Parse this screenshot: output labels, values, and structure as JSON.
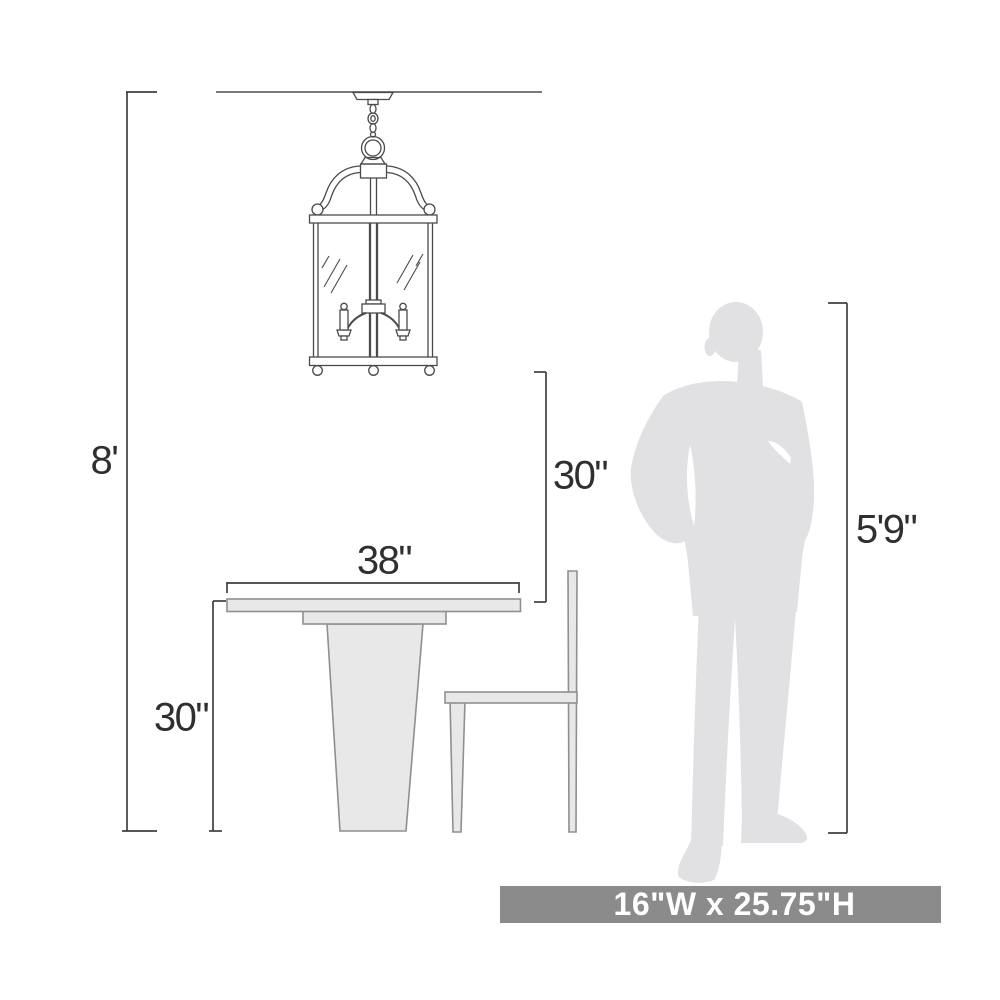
{
  "diagram": {
    "type": "product-scale-diagram",
    "dimensions": {
      "ceiling_height": "8'",
      "fixture_to_table": "30\"",
      "table_width": "38\"",
      "table_height": "30\"",
      "person_height": "5'9\""
    },
    "footer": {
      "fixture_size": "16\"W x 25.75\"H"
    },
    "elements": {
      "fixture": "pendant-lantern-2-candle",
      "furniture": [
        "pedestal-dining-table",
        "side-chair"
      ],
      "figure": "standing-man-silhouette",
      "reference": "ceiling-line"
    },
    "colors": {
      "line_art": "#4a4a4a",
      "dimension_lines": "#3f3f3f",
      "furniture_fill": "#e8e8e8",
      "furniture_stroke": "#8f8f8f",
      "silhouette_fill": "#e1e1e3",
      "ceiling_line": "#7a7a7a",
      "footer_bar_bg": "#8b8b8b",
      "footer_bar_text": "#ffffff",
      "background": "#ffffff"
    }
  }
}
